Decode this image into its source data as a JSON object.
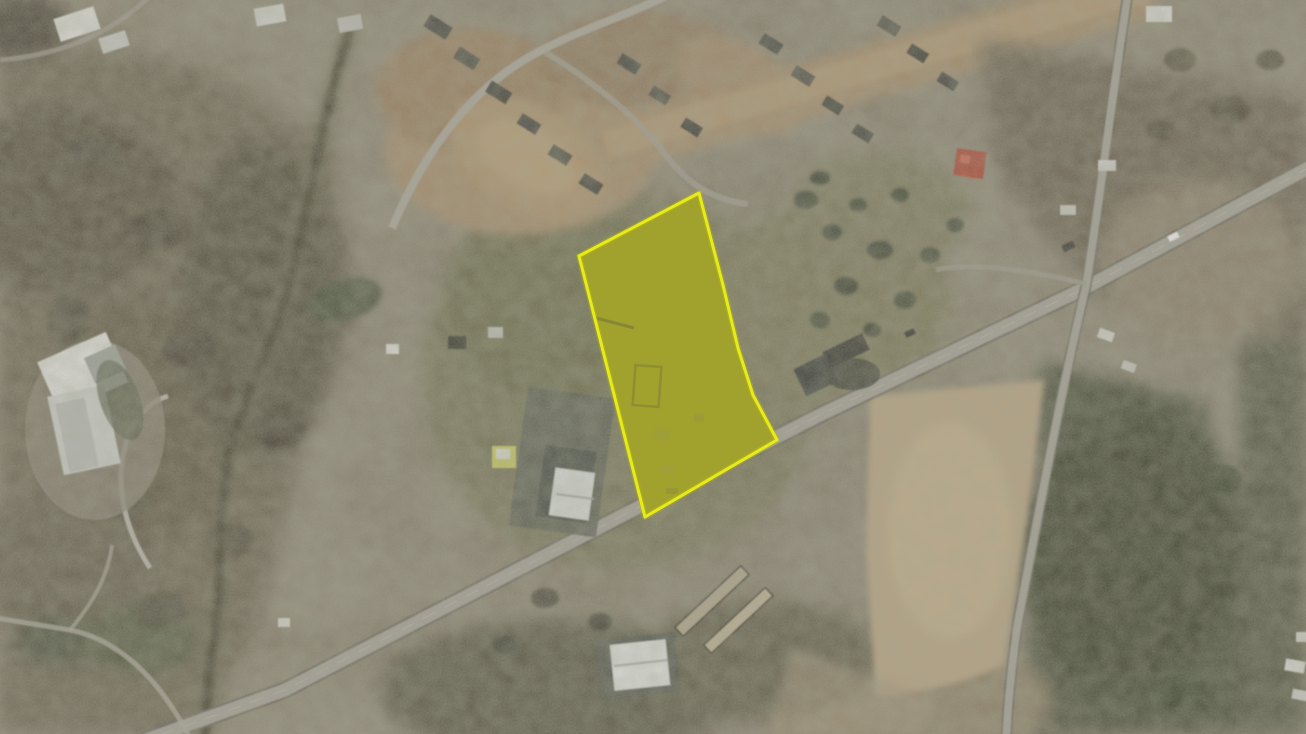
{
  "page": {
    "type": "satellite-map-view",
    "visible_text": "",
    "description": "Aerial satellite photograph with one land parcel highlighted by a yellow outline and translucent yellow fill; a divided highway crosses diagonally below the parcel, a secondary road runs down the right side, a residential subdivision with bare dirt lots sits at top center, dark woodland covers the left half, and tan plowed fields sit right of center."
  },
  "map": {
    "kind": "aerial-satellite-imagery",
    "highlighted_parcel": {
      "points": "699,193 723,285 738,348 753,395 777,440 645,517 579,256",
      "outline_color": "#e9ed18",
      "fill_color": "#d8d800",
      "fill_opacity": "0.38",
      "underlay_color": "#80804a"
    },
    "roads": {
      "highway": {
        "d": "M 1312,166 L 1085,288 L 820,415 L 637,508 L 285,690 L 118,750"
      },
      "side_road": {
        "d": "M 1128,-6 C 1112,95 1100,200 1086,286 C 1062,388 1040,505 1018,622 C 1012,662 1008,700 1006,742"
      },
      "subdivision_street": {
        "d": "M 392,228 C 430,138 482,80 542,50 C 584,28 626,16 670,-6"
      },
      "street_branch": {
        "d": "M 545,52 C 600,86 640,120 668,158 C 690,186 715,200 748,204"
      },
      "spur_road": {
        "d": "M 1086,284 C 1030,270 972,262 936,270"
      },
      "driveway": {
        "d": "M 150,568 C 120,522 112,470 132,428 C 141,411 154,400 168,396"
      },
      "trail_a": {
        "d": "M -4,618 L 70,630 C 120,640 160,680 190,738"
      },
      "trail_b": {
        "d": "M 70,630 C 95,600 108,575 112,545"
      },
      "top_left_road": {
        "d": "M 0,60 C 60,55 110,35 150,-4"
      }
    },
    "palette": {
      "terrain_base": "#847c6b",
      "woods_dark": "#57523f",
      "grass_olive": "#7b795c",
      "field_tan": "#b3a081",
      "dirt_brown": "#a08a6c",
      "road_gray": "#a19d94",
      "road_casing": "#6b675d",
      "building_white": "#d6d6d2",
      "building_gray_roof": "#4c4c44",
      "building_red_roof": "#a84a38",
      "forest_green": "#4f5340"
    }
  }
}
